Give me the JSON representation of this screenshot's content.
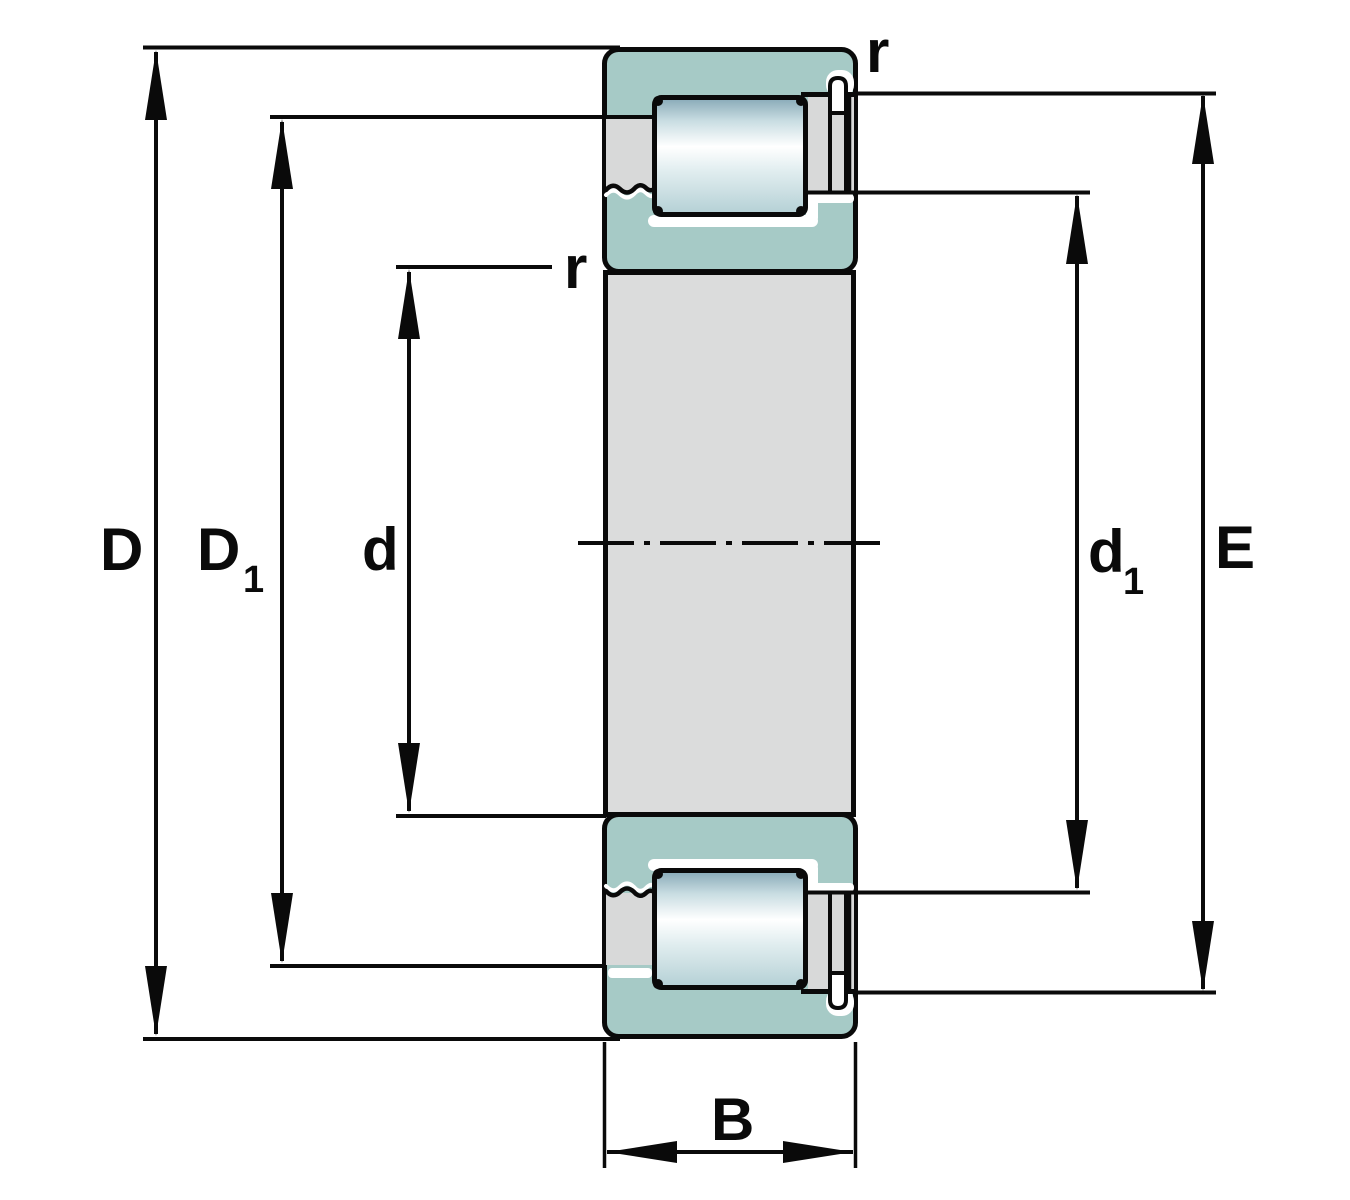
{
  "drawing": {
    "kind": "cylindrical-roller-bearing-cross-section",
    "labels": {
      "outer_diameter": "D",
      "shoulder_diameter_main": "D",
      "shoulder_diameter_sub": "1",
      "bore_diameter": "d",
      "inner_shoulder_main": "d",
      "inner_shoulder_sub": "1",
      "raceway_diameter": "E",
      "width": "B",
      "corner_radius_top": "r",
      "corner_radius_mid": "r"
    },
    "colors": {
      "background": "#ffffff",
      "outline": "#0a0a0a",
      "ring_fill": "#a6cac6",
      "steel_fill": "#d8d9d9",
      "bore_fill": "#dbdcdc",
      "highlight": "#ffffff",
      "roller_top": "#86a8b6",
      "roller_upper": "#c9dde2",
      "roller_white": "#ffffff",
      "roller_lower": "#e2eef0",
      "roller_bottom": "#b4d0d5"
    }
  }
}
